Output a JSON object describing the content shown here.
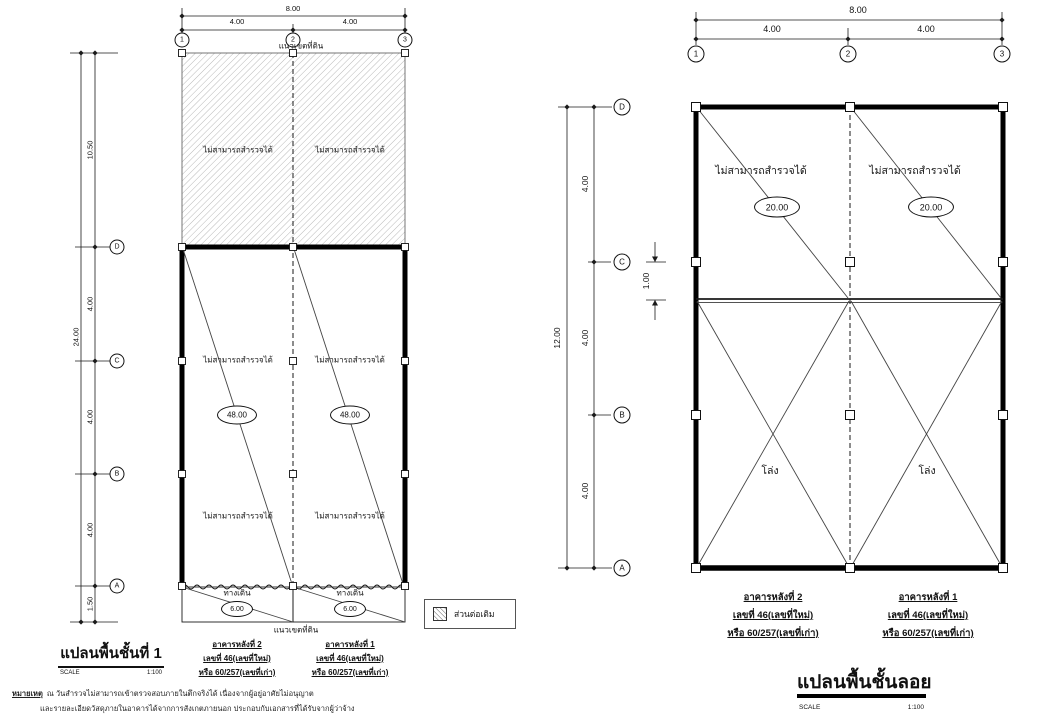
{
  "colors": {
    "line": "#1a1a1a",
    "hatch_line": "#9a9a9a"
  },
  "shared": {
    "no_survey_label": "ไม่สามารถสำรวจได้",
    "boundary_label": "แนวเขตที่ดิน",
    "scale_label": "SCALE",
    "scale_value": "1:100",
    "grid_cols": [
      "1",
      "2",
      "3"
    ],
    "grid_rows": [
      "D",
      "C",
      "B",
      "A"
    ],
    "building_2": {
      "name": "อาคารหลังที่ 2",
      "addr_new": "เลขที่ 46(เลขที่ใหม่)",
      "addr_old": "หรือ 60/257(เลขที่เก่า)"
    },
    "building_1": {
      "name": "อาคารหลังที่ 1",
      "addr_new": "เลขที่ 46(เลขที่ใหม่)",
      "addr_old": "หรือ 60/257(เลขที่เก่า)"
    }
  },
  "plan_first_floor": {
    "title": "แปลนพื้นชั้นที่ 1",
    "dim_total_width": "8.00",
    "dim_bay_left": "4.00",
    "dim_bay_right": "4.00",
    "dim_total_height": "24.00",
    "dim_seg_boundary_d": "10.50",
    "dim_seg_d_c": "4.00",
    "dim_seg_c_b": "4.00",
    "dim_seg_b_a": "4.00",
    "dim_seg_walkway": "1.50",
    "bay_area": "48.00",
    "walkway_label": "ทางเดิน",
    "walkway_area": "6.00"
  },
  "plan_mezzanine": {
    "title": "แปลนพื้นชั้นลอย",
    "dim_total_width": "8.00",
    "dim_bay_left": "4.00",
    "dim_bay_right": "4.00",
    "dim_total_height": "12.00",
    "dim_seg_d_c": "4.00",
    "dim_seg_c_mezz": "1.00",
    "dim_seg_c_b": "4.00",
    "dim_seg_b_a": "4.00",
    "bay_area": "20.00",
    "open_label": "โล่ง"
  },
  "legend": {
    "extension_label": "ส่วนต่อเติม"
  },
  "note": {
    "heading": "หมายเหตุ",
    "line1": "ณ วันสำรวจไม่สามารถเข้าตรวจสอบภายในตึกจริงได้ เนื่องจากผู้อยู่อาศัยไม่อนุญาต",
    "line2": "และรายละเอียดวัสดุภายในอาคารได้จากการสังเกตภายนอก ประกอบกับเอกสารที่ได้รับจากผู้ว่าจ้าง"
  }
}
